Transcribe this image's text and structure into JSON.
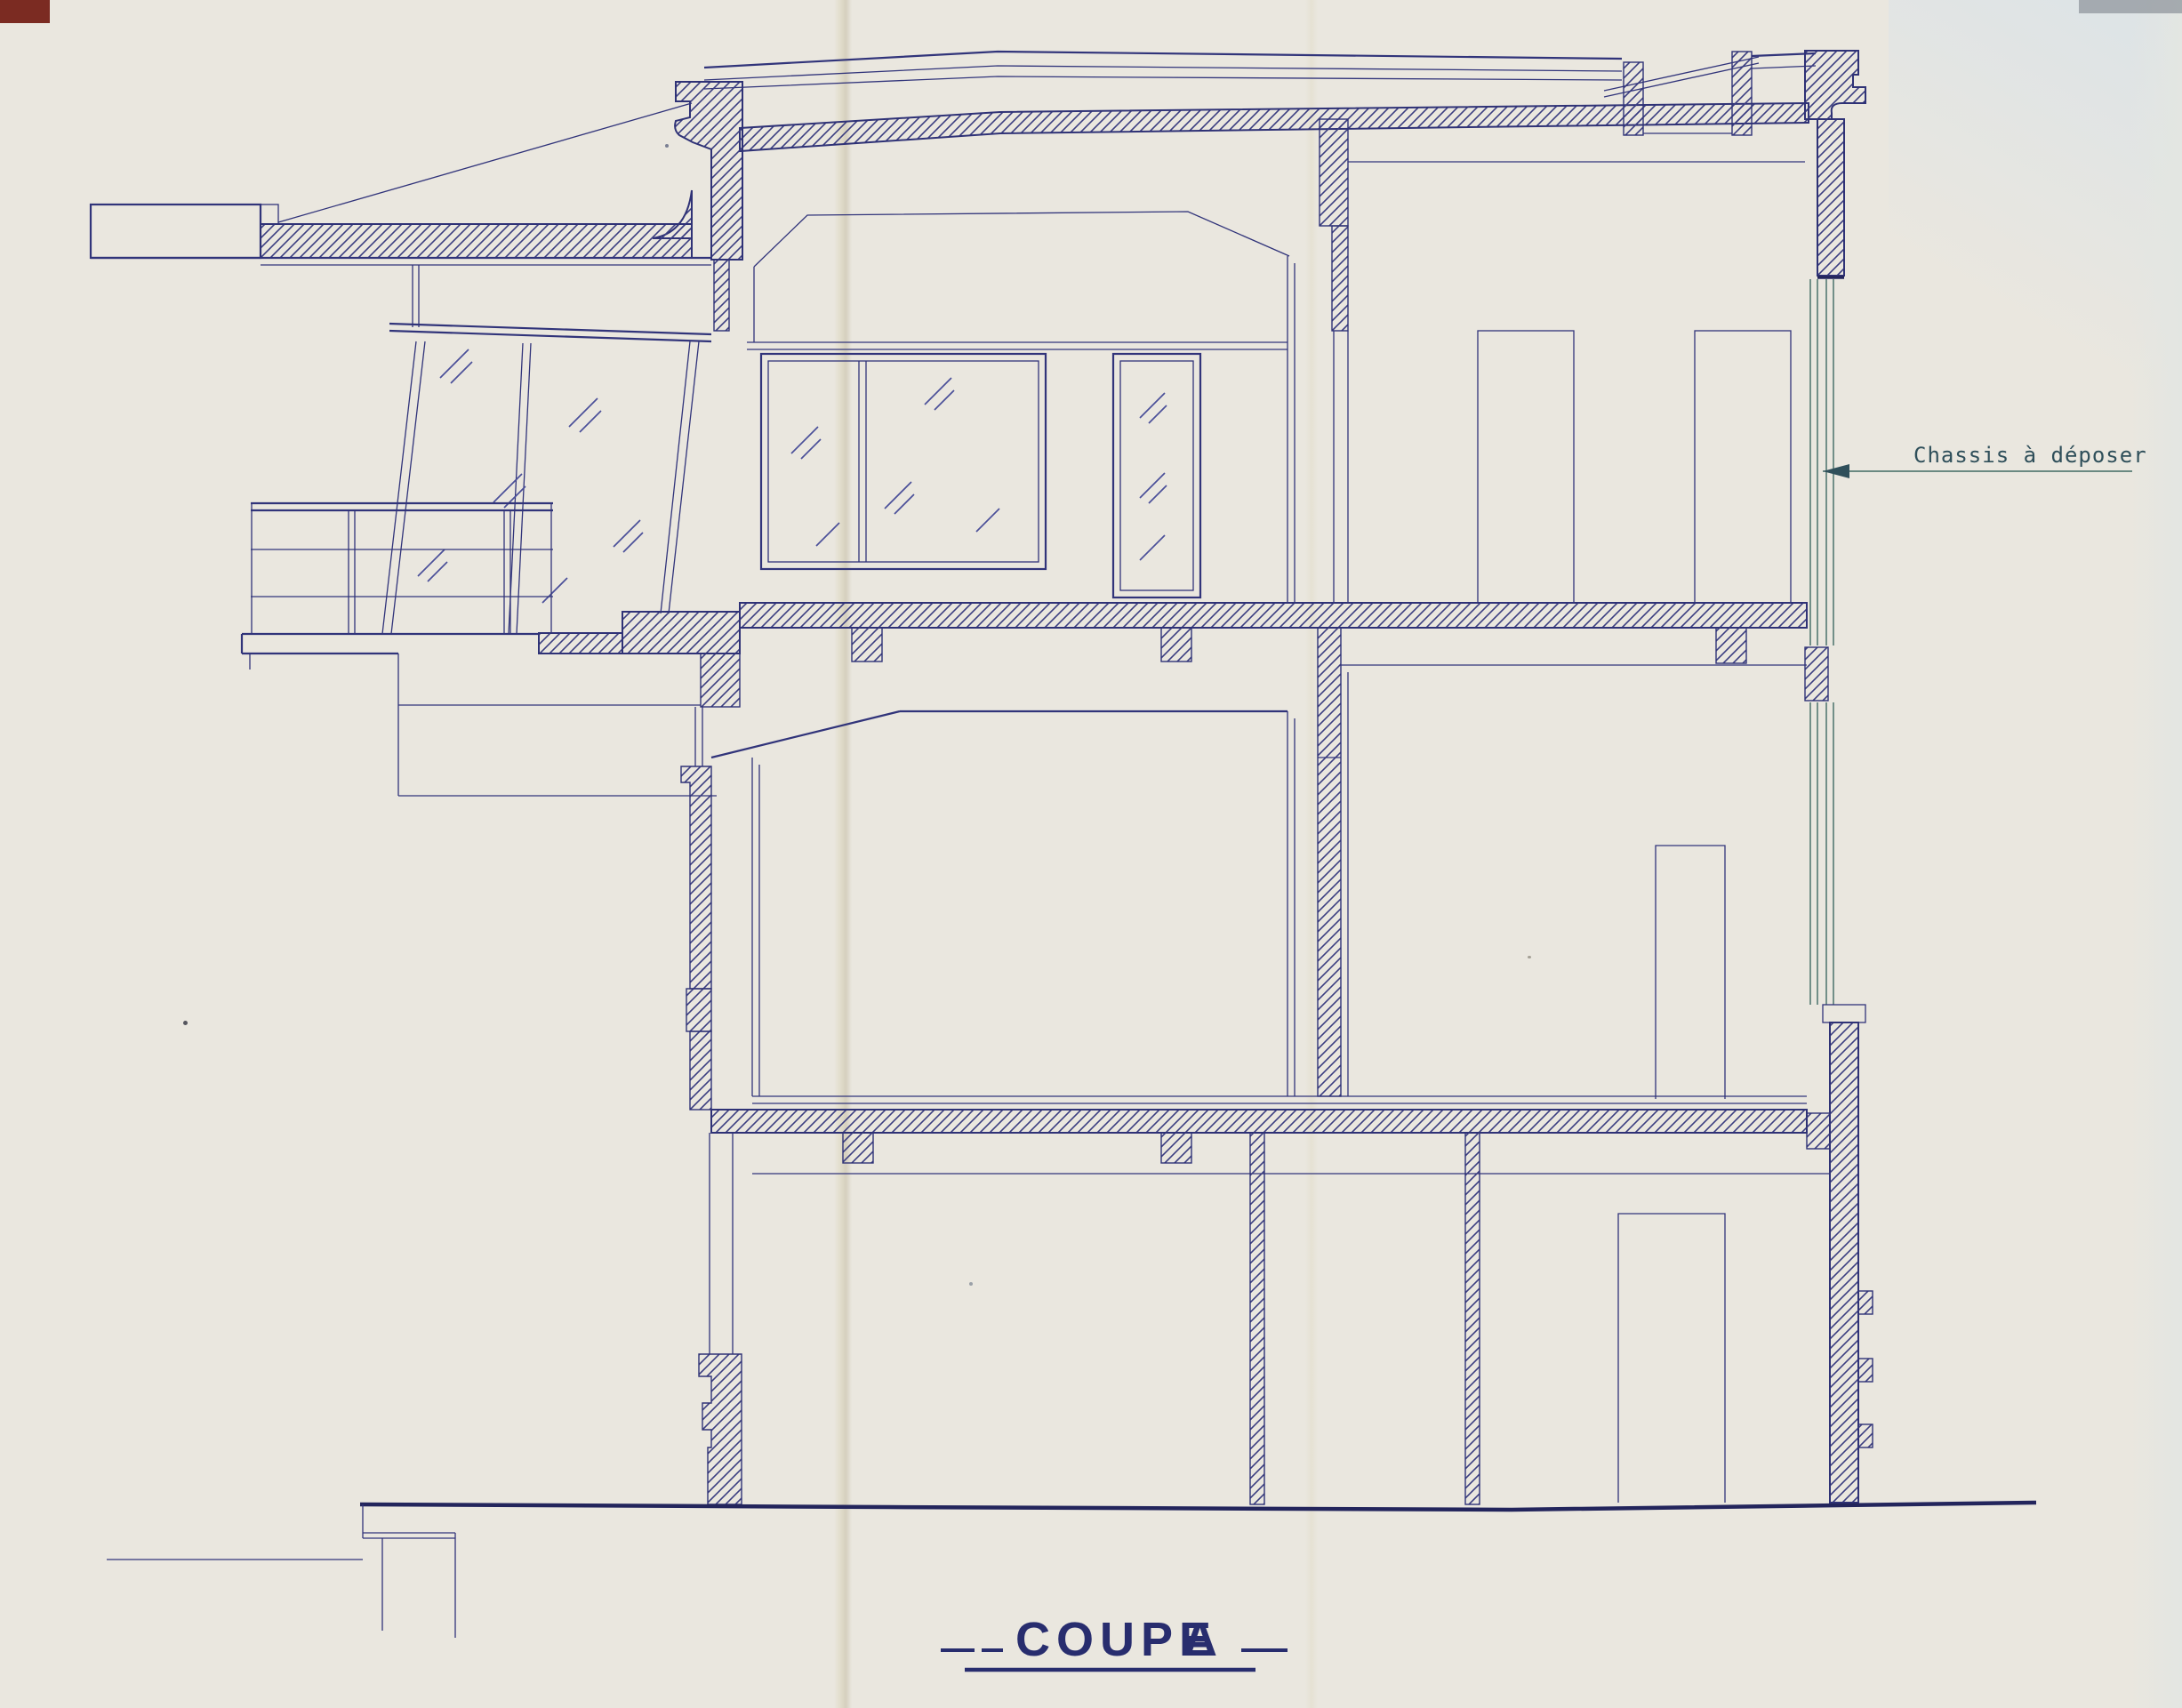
{
  "drawing": {
    "type": "architectural-section",
    "title": {
      "word1": "COUPE",
      "word2": "A"
    },
    "annotation": {
      "text": "Chassis à déposer",
      "target": "right-facade-window-frame"
    },
    "colors": {
      "paper": "#eae7df",
      "ink": "#31347a",
      "ink_dark": "#23255c",
      "ink_teal": "#3f6a62",
      "title_ink": "#282d6e",
      "annotation_ink": "#2f4f5a",
      "corner_mark": "#7b2b22"
    }
  }
}
